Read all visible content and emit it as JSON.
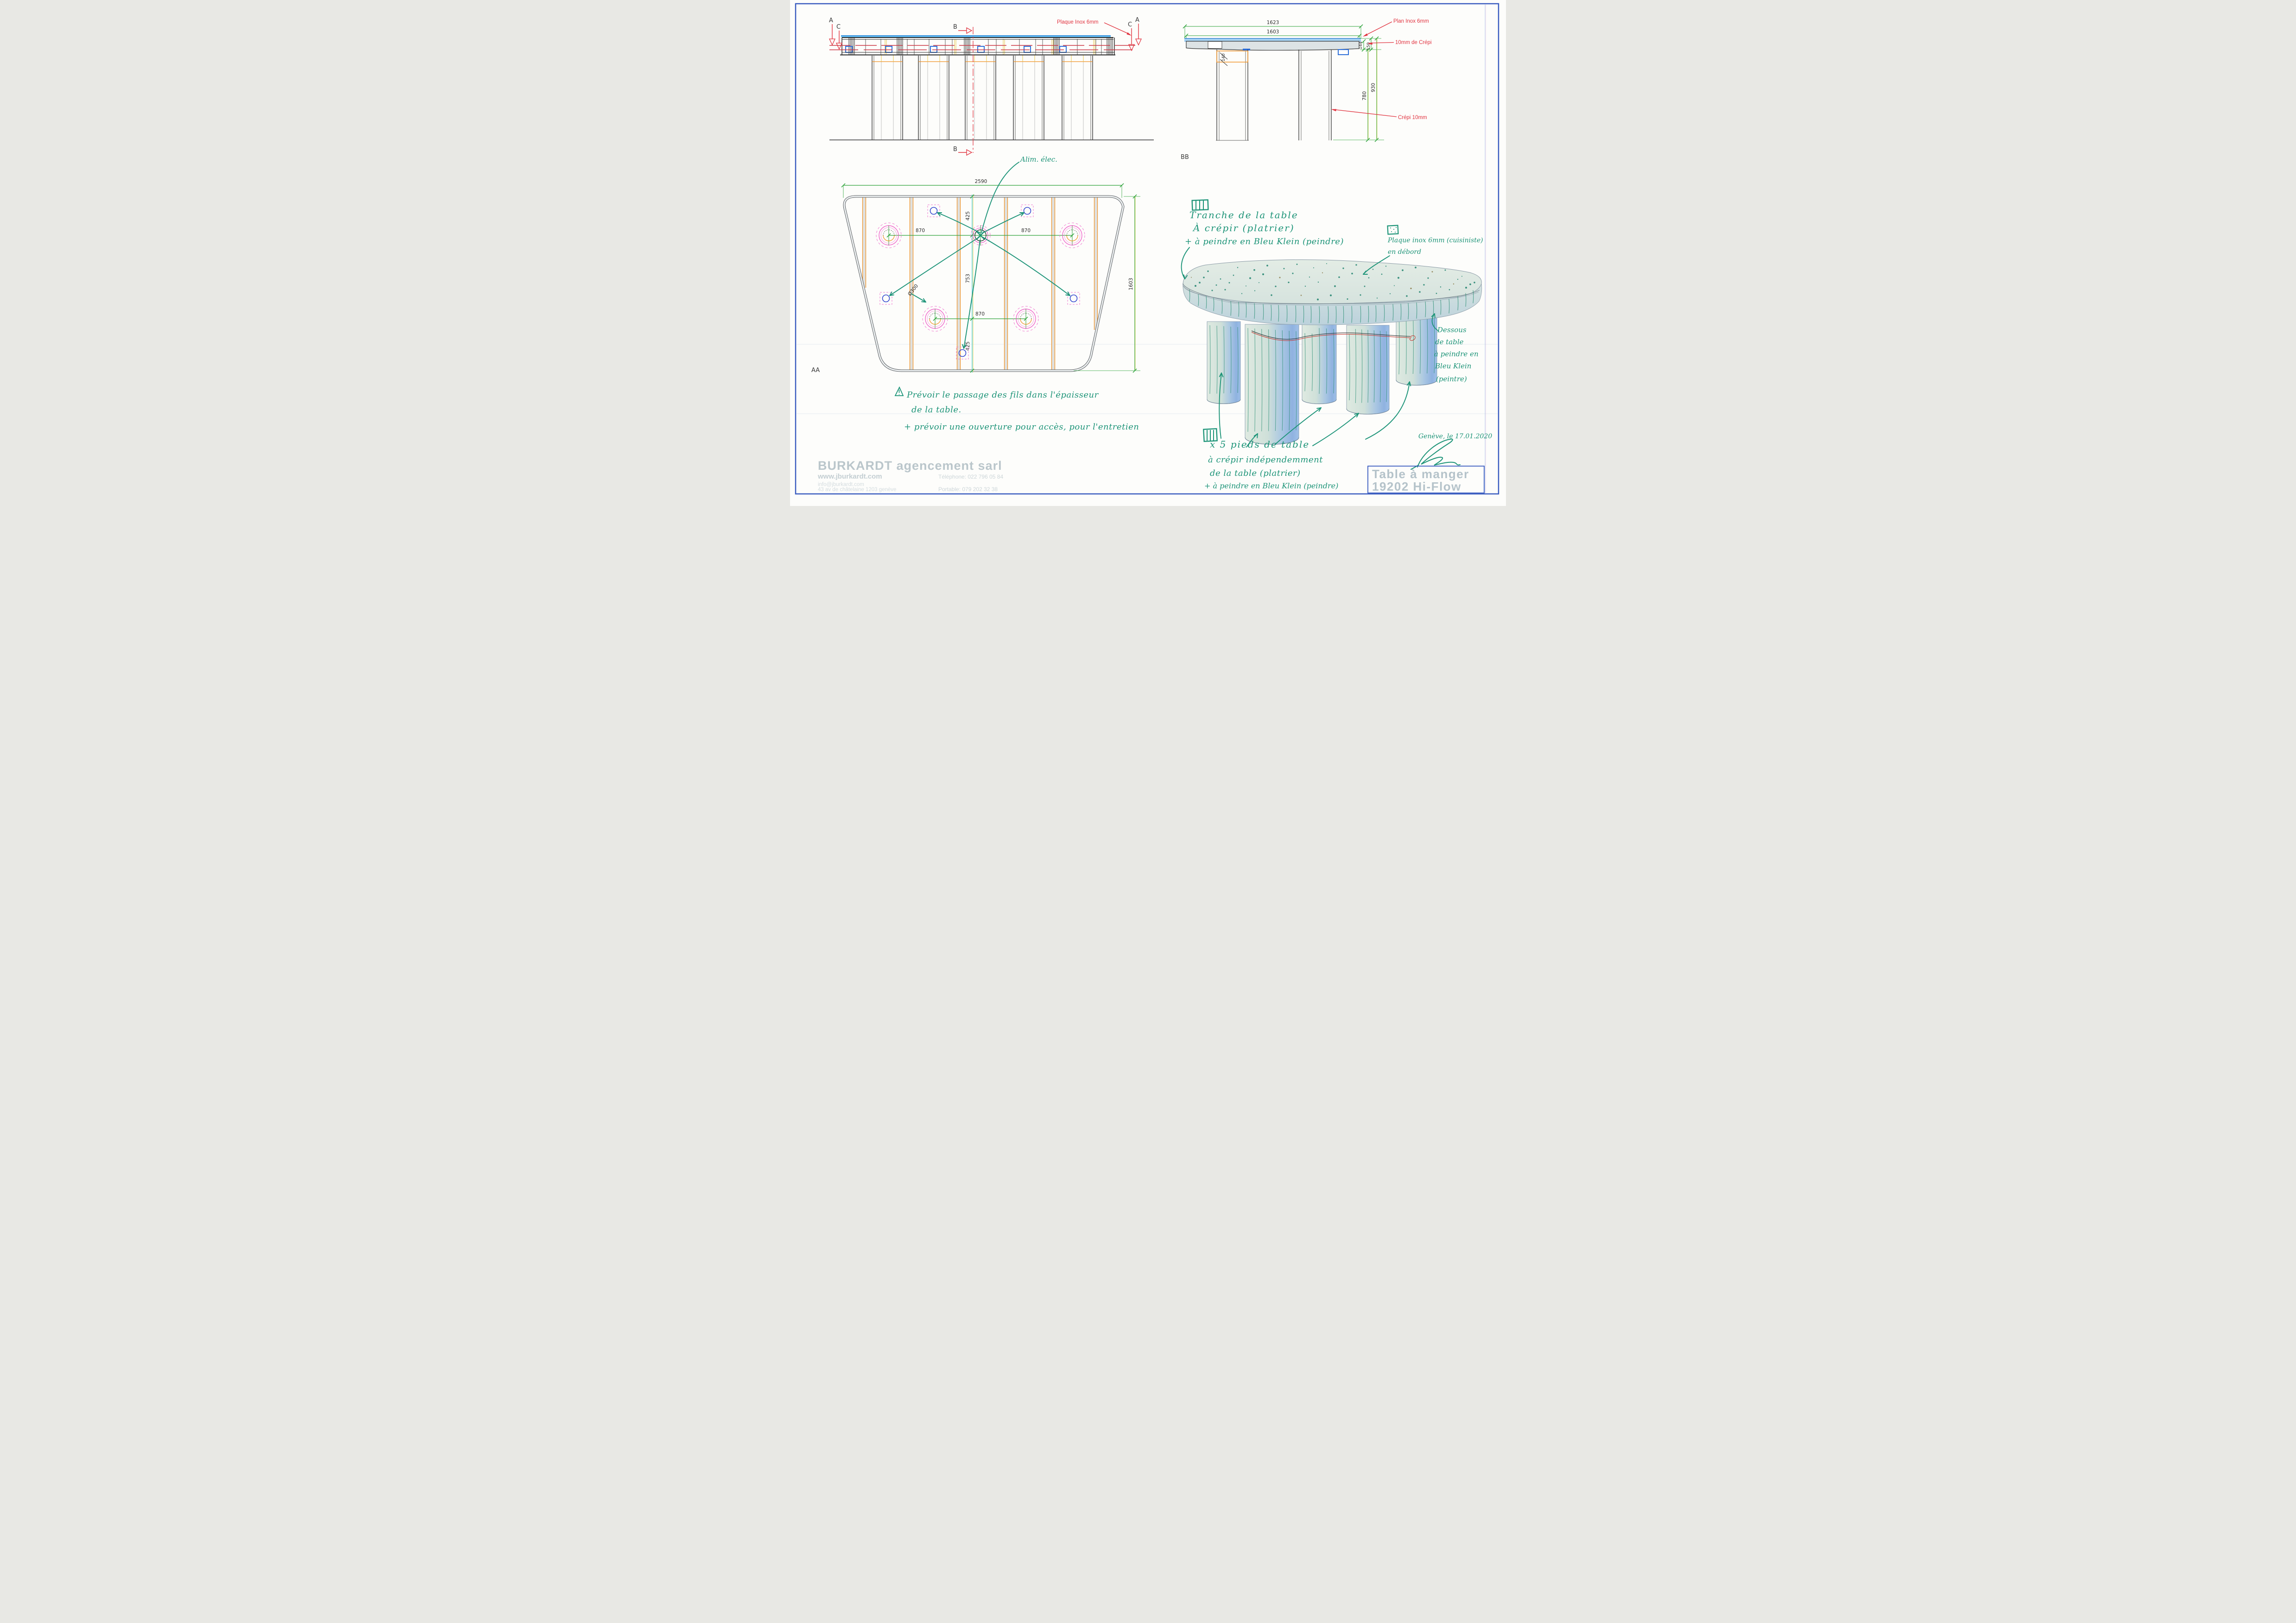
{
  "sheet": {
    "background": "#fdfdfb",
    "frame_color": "#3a5cc0"
  },
  "colors": {
    "dimension_green": "#2fa33b",
    "annotation_red": "#e13440",
    "hand_teal": "#1d9478",
    "batten_orange": "#f09020",
    "inox_blue": "#5cb8f0",
    "clip_blue": "#2f6fd8",
    "magenta": "#ee4fc4",
    "cyan_section": "#45c8d2",
    "title_gray": "#b5c3ca"
  },
  "elevation": {
    "marker_a_left": "A",
    "marker_c_left": "C",
    "marker_b_top": "B",
    "marker_b_bottom": "B",
    "marker_c_right": "C",
    "marker_a_right": "A",
    "note_plaque_inox": "Plaque Inox 6mm"
  },
  "section_bb": {
    "view_label": "BB",
    "dim_inox_width": "1623",
    "dim_body_width": "1603",
    "dim_leg_offset": "140",
    "dim_thickness_body": "144",
    "dim_thickness_total": "150",
    "dim_height_total": "930",
    "dim_height_under": "780",
    "note_plan_inox": "Plan Inox 6mm",
    "note_crepi_top": "10mm de Crépi",
    "note_crepi_side": "Crépi 10mm"
  },
  "plan": {
    "view_label": "AA",
    "dim_width": "2590",
    "dim_depth": "1603",
    "dim_870_left": "870",
    "dim_870_right": "870",
    "dim_870_bottom": "870",
    "dim_425_top": "425",
    "dim_753_mid": "753",
    "dim_425_bottom": "425",
    "dim_leg_diameter": "Ø300",
    "note_alim_elec": "Alim. élec."
  },
  "sketch": {
    "tranche_line1": "Tranche de la table",
    "tranche_line2": "À crépir (platrier)",
    "tranche_line3": "+ à peindre en Bleu Klein (peindre)",
    "plaque_line1": "Plaque inox 6mm (cuisiniste)",
    "plaque_line2": "en débord",
    "dessous_line1": "Dessous",
    "dessous_line2": "de table",
    "dessous_line3": "à peindre en",
    "dessous_line4": "Bleu Klein",
    "dessous_line5": "(peintre)",
    "pieds_line1": "x 5 pieds de table",
    "pieds_line2": "à crépir indépendemment",
    "pieds_line3": "de la table (platrier)",
    "pieds_line4": "+ à peindre en Bleu Klein (peindre)",
    "date_note": "Genève, le 17.01.2020"
  },
  "warning_note": {
    "line1": "Prévoir le passage des fils dans l'épaisseur",
    "line2": "de la table.",
    "line3": "+ prévoir une ouverture pour accès, pour l'entretien"
  },
  "footer": {
    "company": "BURKARDT agencement sarl",
    "website": "www.jburkardt.com",
    "email": "info@jburkardt.com",
    "address": "43 av de châtelaine 1203 genève",
    "phone_label": "Téléphone: 022 796 05 84",
    "mobile_label": "Portable: 079 202 32 38"
  },
  "title_block": {
    "line1": "Table à manger",
    "line2": "19202 Hi-Flow"
  }
}
